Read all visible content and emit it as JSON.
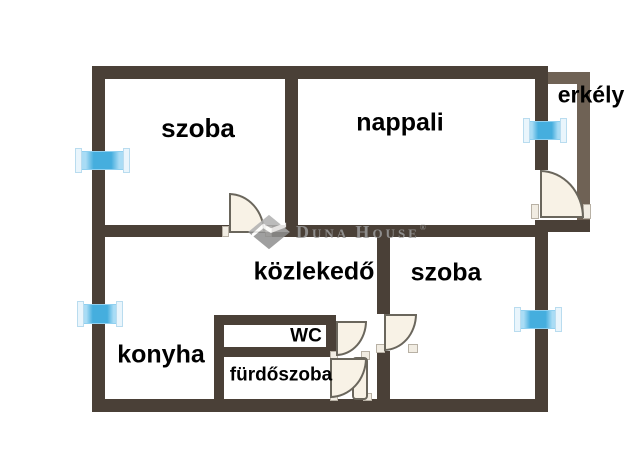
{
  "plan": {
    "type": "floor-plan",
    "rooms": [
      {
        "id": "szoba-top",
        "label": "szoba"
      },
      {
        "id": "nappali",
        "label": "nappali"
      },
      {
        "id": "erkely",
        "label": "erkély"
      },
      {
        "id": "kozlekedo",
        "label": "közlekedő"
      },
      {
        "id": "szoba-bottom",
        "label": "szoba"
      },
      {
        "id": "konyha",
        "label": "konyha"
      },
      {
        "id": "wc",
        "label": "WC"
      },
      {
        "id": "furdoszoba",
        "label": "fürdőszoba"
      }
    ],
    "window_count": 4,
    "door_count": 5
  },
  "watermark": {
    "logo": "duna-house-diamond",
    "name_parts": {
      "d": "D",
      "una": "UNA",
      "h": "H",
      "ouse": "OUSE",
      "reg": "®"
    }
  },
  "colors": {
    "wall_dark": "#4a4037",
    "wall_light": "#6f6255",
    "window_blue": "#45aede",
    "window_pale": "#a9dcf5",
    "door_fill": "#f8f2e6",
    "door_stroke": "#6a665c",
    "label": "#000000",
    "watermark_gray": "#9b9b9b",
    "background": "#ffffff"
  }
}
